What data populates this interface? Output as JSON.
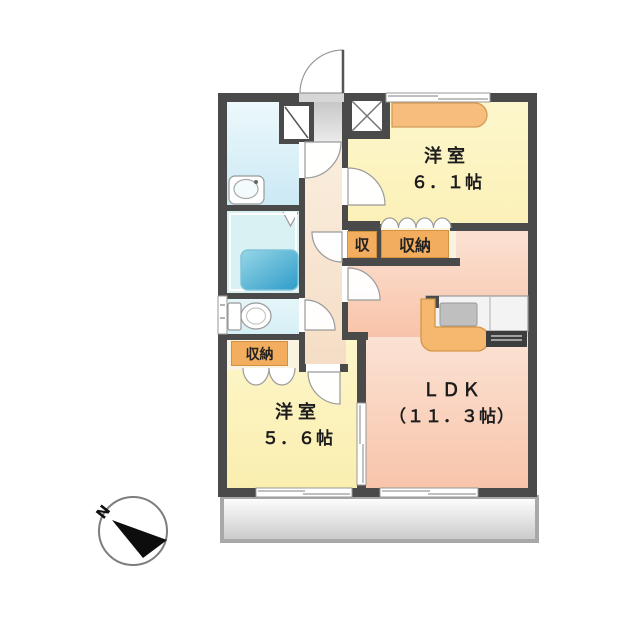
{
  "plan": {
    "rooms": {
      "bedroom_a": {
        "name": "洋室",
        "size": "６．１帖"
      },
      "bedroom_b": {
        "name": "洋室",
        "size": "５．６帖"
      },
      "ldk": {
        "name": "ＬＤＫ",
        "size": "（１１．３帖）"
      }
    },
    "closets": {
      "bedroom_a_closet": "収納",
      "hall_closet": "収",
      "bedroom_b_closet": "収納"
    },
    "compass": {
      "north": "N"
    },
    "fixtures": {
      "bathtub": "bathtub",
      "sink": "sink",
      "toilet": "toilet",
      "washing_machine_pan": "washing-machine-pan",
      "kitchen_counter": "kitchen-counter",
      "pipe_space": "pipe-space",
      "entry": "entry",
      "balcony": "balcony"
    },
    "colors": {
      "wall": "#4a4a4a",
      "bedroom_fill": "#fcf4c2",
      "ldk_fill": "#f9cfb8",
      "hallway_fill": "#f9ecd9",
      "washroom_fill": "#dbf2f9",
      "bathroom_fill": "#d9f1f3",
      "bathtub_fill": "#3fa8cf",
      "storage_label_bg": "#f2ad5e",
      "balcony_fill": "#e0e0e0",
      "kitchen_accent": "#f6b76e"
    }
  }
}
